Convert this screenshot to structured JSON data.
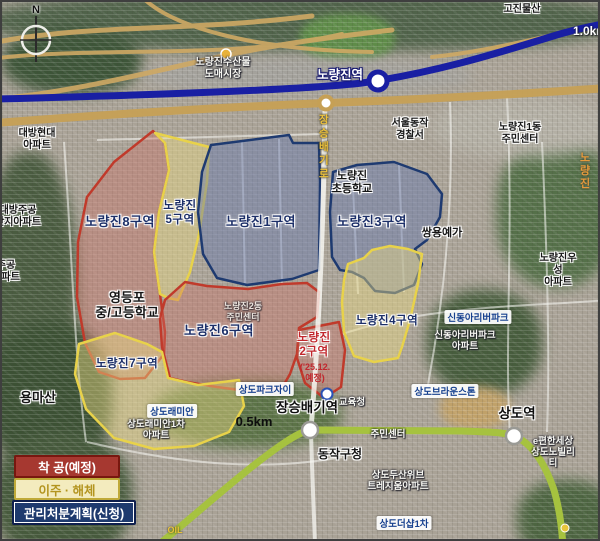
{
  "map_title": "노량진 재개발 구역 위성지도",
  "compass": {
    "label": "N"
  },
  "scale": {
    "north_east": "1.0km",
    "center": "0.5km"
  },
  "legend": {
    "items": [
      {
        "label": "착 공(예정)",
        "bg": "#a63830",
        "text_color": "#ffffff",
        "swatch": "red"
      },
      {
        "label": "이주 · 해체",
        "bg": "#f3ebbe",
        "text_color": "#b3941f",
        "swatch": "yellow"
      },
      {
        "label": "관리처분계획(신청)",
        "bg": "#1e3a6e",
        "text_color": "#ffffff",
        "swatch": "blue"
      }
    ]
  },
  "transit": {
    "line1_color": "#191fa3",
    "line9_color": "#c6a055",
    "line7_color": "#a6c23f"
  },
  "stations": [
    {
      "name": "노량진역"
    },
    {
      "name": "장승배기역"
    },
    {
      "name": "상도역"
    }
  ],
  "districts": [
    {
      "name": "노량진8구역",
      "label": "노량진8구역",
      "status": "착공(예정)",
      "outline": "red"
    },
    {
      "name": "노량진5구역",
      "label": "노량진\n5구역",
      "status": "이주·해체",
      "outline": "yellow"
    },
    {
      "name": "노량진1구역",
      "label": "노량진1구역",
      "status": "관리처분계획(신청)",
      "outline": "blue"
    },
    {
      "name": "노량진3구역",
      "label": "노량진3구역",
      "status": "관리처분계획(신청)",
      "outline": "blue"
    },
    {
      "name": "노량진4구역",
      "label": "노량진4구역",
      "status": "이주·해체",
      "outline": "yellow"
    },
    {
      "name": "노량진6구역",
      "label": "노량진6구역",
      "status": "착공(예정)",
      "outline": "red"
    },
    {
      "name": "노량진2구역",
      "label": "노량진\n2구역",
      "note": "('25.12.\n예정)",
      "status": "착공(예정)",
      "outline": "red"
    },
    {
      "name": "노량진7구역",
      "label": "노량진7구역",
      "status": "이주·해체",
      "outline": "yellow"
    }
  ],
  "places": [
    {
      "text": "노량진수산물\n도매시장"
    },
    {
      "text": "고진물산"
    },
    {
      "text": "대방현대\n아파트"
    },
    {
      "text": "대방주공\n단지아파트"
    },
    {
      "text": "주공\n아파트"
    },
    {
      "text": "서울동작\n경찰서"
    },
    {
      "text": "노량진1동\n주민센터"
    },
    {
      "text": "노량진"
    },
    {
      "text": "노량진\n초등학교"
    },
    {
      "text": "쌍용예가"
    },
    {
      "text": "노량진우성\n아파트"
    },
    {
      "text": "영등포\n중/고등학교"
    },
    {
      "text": "신동아리버파크"
    },
    {
      "text": "신동아리버파크\n아파트"
    },
    {
      "text": "노량진2동\n주민센터"
    },
    {
      "text": "용마산"
    },
    {
      "text": "상도래미안"
    },
    {
      "text": "상도래미안1차\n아파트"
    },
    {
      "text": "상도파크자이"
    },
    {
      "text": "교육청"
    },
    {
      "text": "동작구청"
    },
    {
      "text": "주민센터"
    },
    {
      "text": "상도브라운스톤"
    },
    {
      "text": "e편한세상\n상도노빌리티"
    },
    {
      "text": "상도두산위브\n트레지움아파트"
    },
    {
      "text": "상도더샵1차"
    },
    {
      "text": "OIL"
    },
    {
      "text": "장승배기로"
    }
  ]
}
